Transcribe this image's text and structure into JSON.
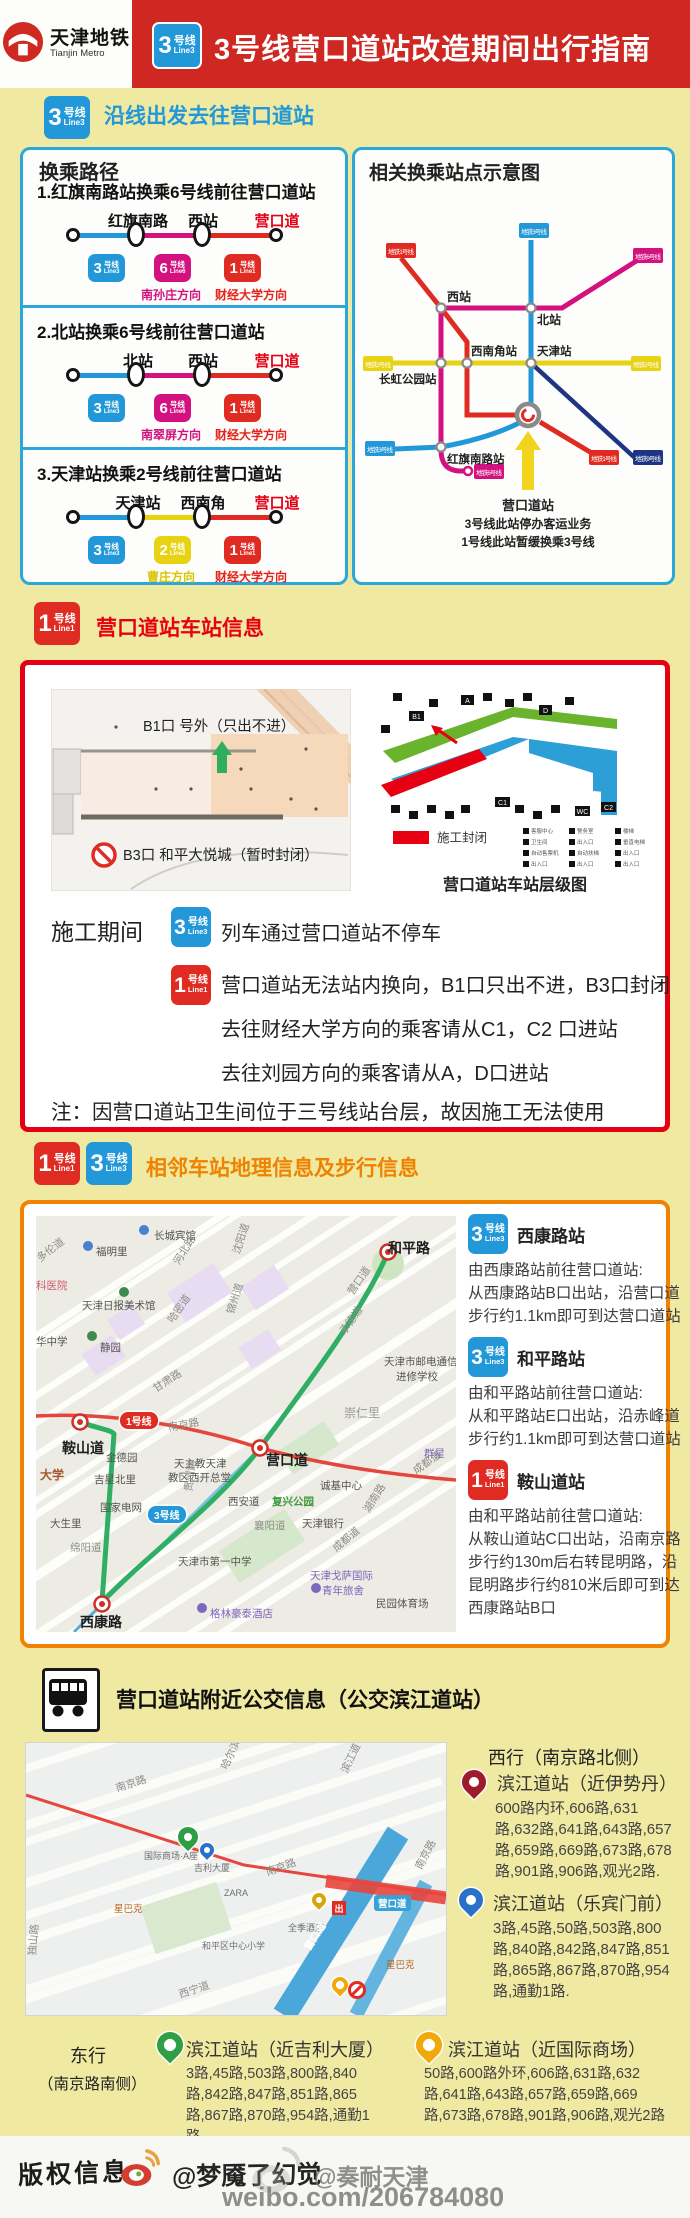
{
  "header": {
    "brand_cn": "天津地铁",
    "brand_en": "Tianjin Metro",
    "badge": {
      "n": "3",
      "u": "号线",
      "e": "Line3"
    },
    "title": "3号线营口道站改造期间出行指南"
  },
  "badges": {
    "l1": {
      "n": "1",
      "u": "号线",
      "e": "Line1"
    },
    "l2": {
      "n": "2",
      "u": "号线",
      "e": "Line2"
    },
    "l3": {
      "n": "3",
      "u": "号线",
      "e": "Line3"
    },
    "l6": {
      "n": "6",
      "u": "号线",
      "e": "Line6"
    }
  },
  "sectionA": {
    "title": "沿线出发去往营口道站"
  },
  "transfer": {
    "title": "换乘路径",
    "routes": [
      {
        "title": "1.红旗南路站换乘6号线前往营口道站",
        "stations": [
          "红旗南路",
          "西站",
          "营口道"
        ],
        "dir1": "南孙庄方向",
        "dir2": "财经大学方向"
      },
      {
        "title": "2.北站换乘6号线前往营口道站",
        "stations": [
          "北站",
          "西站",
          "营口道"
        ],
        "dir1": "南翠屏方向",
        "dir2": "财经大学方向"
      },
      {
        "title": "3.天津站换乘2号线前往营口道站",
        "stations": [
          "天津站",
          "西南角",
          "营口道"
        ],
        "dir1": "曹庄方向",
        "dir2": "财经大学方向"
      }
    ]
  },
  "schematic": {
    "title": "相关换乘站点示意图",
    "stations": [
      "西站",
      "北站",
      "西南角站",
      "天津站",
      "长虹公园站",
      "红旗南路站"
    ],
    "caps": {
      "c1tl": "地铁1号线",
      "c3top": "地铁3号线",
      "c6tr": "地铁6号线",
      "c2l": "地铁2号线",
      "c2r": "地铁2号线",
      "c3l": "地铁3号线",
      "c6b": "地铁6号线",
      "c1br": "地铁1号线",
      "c9br": "地铁9号线"
    },
    "notes": [
      "营口道站",
      "3号线此站停办客运业务",
      "1号线此站暂缓换乘3号线"
    ]
  },
  "stationInfo": {
    "title": "营口道站车站信息",
    "floorplan": {
      "b1": "B1口 号外（只出不进）",
      "b3": "B3口 和平大悦城（暂时封闭）"
    },
    "level": {
      "legend": "施工封闭",
      "caption": "营口道站车站层级图",
      "exits": [
        "B1",
        "A",
        "D",
        "C1",
        "C2",
        "WC"
      ],
      "legend_items": [
        "客服中心",
        "警务室",
        "楼梯",
        "卫生间",
        "出入口",
        "垂直电梯",
        "自动售票机",
        "自动扶梯",
        "出入口",
        "出入口",
        "出入口",
        "出入口"
      ]
    },
    "construction": {
      "label": "施工期间",
      "line3_text": "列车通过营口道站不停车",
      "line1_lines": [
        "营口道站无法站内换向，B1口只出不进，B3口封闭",
        "去往财经大学方向的乘客请从C1，C2 口进站",
        "去往刘园方向的乘客请从A，D口进站"
      ]
    },
    "note": "注：因营口道站卫生间位于三号线站台层，故因施工无法使用"
  },
  "walk": {
    "title": "相邻车站地理信息及步行信息",
    "entries": [
      {
        "name": "西康路站",
        "lines": [
          "由西康路站前往营口道站:",
          "从西康路站B口出站，沿营口道",
          "步行约1.1km即可到达营口道站"
        ]
      },
      {
        "name": "和平路站",
        "lines": [
          "由和平路站前往营口道站:",
          "从和平路站E口出站，沿赤峰道",
          "步行约1.1km即可到达营口道站"
        ]
      },
      {
        "name": "鞍山道站",
        "lines": [
          "由和平路站前往营口道站:",
          "从鞍山道站C口出站，沿南京路",
          "步行约130m后右转昆明路，沿",
          "昆明路步行约810米后即可到达",
          "西康路站B口"
        ]
      }
    ],
    "map_badges": {
      "line1": "1号线",
      "line3": "3号线"
    },
    "map_labels": [
      {
        "t": "长城宾馆",
        "x": 118,
        "y": 12,
        "c": ""
      },
      {
        "t": "福明里",
        "x": 60,
        "y": 28,
        "c": ""
      },
      {
        "t": "多伦道",
        "x": 2,
        "y": 36,
        "r": -38,
        "c": "lr"
      },
      {
        "t": "河北路",
        "x": 140,
        "y": 40,
        "r": -58,
        "c": "lr"
      },
      {
        "t": "沈阳道",
        "x": 200,
        "y": 30,
        "r": -72,
        "c": "lr"
      },
      {
        "t": "和平路",
        "x": 352,
        "y": 22,
        "c": "ls"
      },
      {
        "t": "科医院",
        "x": 0,
        "y": 62,
        "c": "lp"
      },
      {
        "t": "天津日报美术馆",
        "x": 46,
        "y": 82,
        "c": ""
      },
      {
        "t": "静园",
        "x": 64,
        "y": 124,
        "c": ""
      },
      {
        "t": "锦州道",
        "x": 194,
        "y": 90,
        "r": -72,
        "c": "lr"
      },
      {
        "t": "哈密道",
        "x": 134,
        "y": 98,
        "r": -55,
        "c": "lr"
      },
      {
        "t": "华中学",
        "x": 0,
        "y": 118,
        "c": ""
      },
      {
        "t": "甘肃路",
        "x": 118,
        "y": 166,
        "r": -33,
        "c": "lr"
      },
      {
        "t": "承德道",
        "x": 306,
        "y": 110,
        "r": -55,
        "c": "lr"
      },
      {
        "t": "营口道",
        "x": 314,
        "y": 70,
        "r": -55,
        "c": "lr"
      },
      {
        "t": "天津市邮电通信",
        "x": 348,
        "y": 138,
        "c": ""
      },
      {
        "t": "进修学校",
        "x": 360,
        "y": 153,
        "c": ""
      },
      {
        "t": "崇仁里",
        "x": 308,
        "y": 188,
        "c": "lg"
      },
      {
        "t": "鞍山道",
        "x": 26,
        "y": 222,
        "c": "ls"
      },
      {
        "t": "南京路",
        "x": 132,
        "y": 204,
        "r": -10,
        "c": "lr"
      },
      {
        "t": "群星",
        "x": 388,
        "y": 230,
        "c": "lv"
      },
      {
        "t": "金德园",
        "x": 70,
        "y": 234,
        "c": ""
      },
      {
        "t": "吉星北里",
        "x": 58,
        "y": 256,
        "c": ""
      },
      {
        "t": "大学",
        "x": 4,
        "y": 250,
        "c": "lu"
      },
      {
        "t": "国家电网",
        "x": 64,
        "y": 284,
        "c": ""
      },
      {
        "t": "大生里",
        "x": 14,
        "y": 300,
        "c": ""
      },
      {
        "t": "绵阳道",
        "x": 34,
        "y": 324,
        "c": "lr"
      },
      {
        "t": "天主教天津",
        "x": 138,
        "y": 240,
        "c": ""
      },
      {
        "t": "教区西开总堂",
        "x": 132,
        "y": 254,
        "c": ""
      },
      {
        "t": "营口道",
        "x": 230,
        "y": 234,
        "c": "ls"
      },
      {
        "t": "诚基中心",
        "x": 284,
        "y": 262,
        "c": ""
      },
      {
        "t": "成都道",
        "x": 378,
        "y": 248,
        "r": -35,
        "c": "lr"
      },
      {
        "t": "西安道",
        "x": 192,
        "y": 278,
        "c": ""
      },
      {
        "t": "复兴公园",
        "x": 236,
        "y": 278,
        "c": "lgr"
      },
      {
        "t": "襄阳道",
        "x": 218,
        "y": 302,
        "c": "lr"
      },
      {
        "t": "天津银行",
        "x": 266,
        "y": 300,
        "c": ""
      },
      {
        "t": "贵州路",
        "x": 152,
        "y": 268,
        "r": -82,
        "c": "lr"
      },
      {
        "t": "湖南路",
        "x": 330,
        "y": 288,
        "r": -58,
        "c": "lr"
      },
      {
        "t": "成都道",
        "x": 298,
        "y": 326,
        "r": -40,
        "c": "lr"
      },
      {
        "t": "天津市第一中学",
        "x": 142,
        "y": 338,
        "c": ""
      },
      {
        "t": "天津戈萨国际",
        "x": 274,
        "y": 352,
        "c": "lv"
      },
      {
        "t": "青年旅舍",
        "x": 286,
        "y": 367,
        "c": "lv"
      },
      {
        "t": "民园体育场",
        "x": 340,
        "y": 380,
        "c": ""
      },
      {
        "t": "格林豪泰酒店",
        "x": 174,
        "y": 390,
        "c": "lv"
      },
      {
        "t": "西康路",
        "x": 44,
        "y": 396,
        "c": "ls"
      }
    ]
  },
  "bus": {
    "title": "营口道站附近公交信息（公交滨江道站）",
    "west": {
      "label": "西行（南京路北侧）",
      "stops": [
        {
          "name": "滨江道站（近伊势丹）",
          "routes": "600路内环,606路,631路,632路,641路,643路,657路,659路,669路,673路,678路,901路,906路,观光2路."
        },
        {
          "name": "滨江道站（乐宾门前）",
          "routes": "3路,45路,50路,503路,800路,840路,842路,847路,851路,865路,867路,870路,954路,通勤1路."
        }
      ]
    },
    "east": {
      "label1": "东行",
      "label2": "（南京路南侧）",
      "stops": [
        {
          "name": "滨江道站（近吉利大厦）",
          "routes": "3路,45路,503路,800路,840路,842路,847路,851路,865路,867路,870路,954路,通勤1路."
        },
        {
          "name": "滨江道站（近国际商场）",
          "routes": "50路,600路外环,606路,631路,632路,641路,643路,657路,659路,669路,673路,678路,901路,906路,观光2路"
        }
      ]
    },
    "map_pill": "营口道",
    "exit_sign": "出",
    "map_labels": [
      {
        "t": "南京路",
        "x": 90,
        "y": 38,
        "r": -18,
        "c": "lr"
      },
      {
        "t": "哈尔滨道",
        "x": 198,
        "y": 18,
        "r": -65,
        "c": "lr"
      },
      {
        "t": "滨江道",
        "x": 318,
        "y": 22,
        "r": -65,
        "c": "lr"
      },
      {
        "t": "国际商场·A座",
        "x": 118,
        "y": 106,
        "c": "lg2"
      },
      {
        "t": "吉利大厦",
        "x": 168,
        "y": 118,
        "c": "lg2"
      },
      {
        "t": "ZARA",
        "x": 198,
        "y": 145,
        "c": "lg2"
      },
      {
        "t": "星巴克",
        "x": 88,
        "y": 158,
        "c": "lo"
      },
      {
        "t": "南京路",
        "x": 240,
        "y": 122,
        "r": -20,
        "c": "lr"
      },
      {
        "t": "南京路",
        "x": 392,
        "y": 118,
        "r": -62,
        "c": "lr"
      },
      {
        "t": "全季酒店",
        "x": 262,
        "y": 178,
        "c": "lg2"
      },
      {
        "t": "和平区中心小学",
        "x": 176,
        "y": 196,
        "c": "lg2"
      },
      {
        "t": "星巴克",
        "x": 360,
        "y": 214,
        "c": "lo"
      },
      {
        "t": "西宁道",
        "x": 153,
        "y": 244,
        "r": -18,
        "c": "lr"
      },
      {
        "t": "独山路",
        "x": 6,
        "y": 205,
        "r": -85,
        "c": "lr"
      },
      {
        "t": "营口道",
        "x": 280,
        "y": 198,
        "r": -57,
        "c": "lw"
      }
    ]
  },
  "footer": {
    "copyright": "版权信息",
    "handle": "@梦魇了幻觉",
    "watermark1": "@奏耐天津",
    "watermark2": "weibo.com/206784080"
  }
}
